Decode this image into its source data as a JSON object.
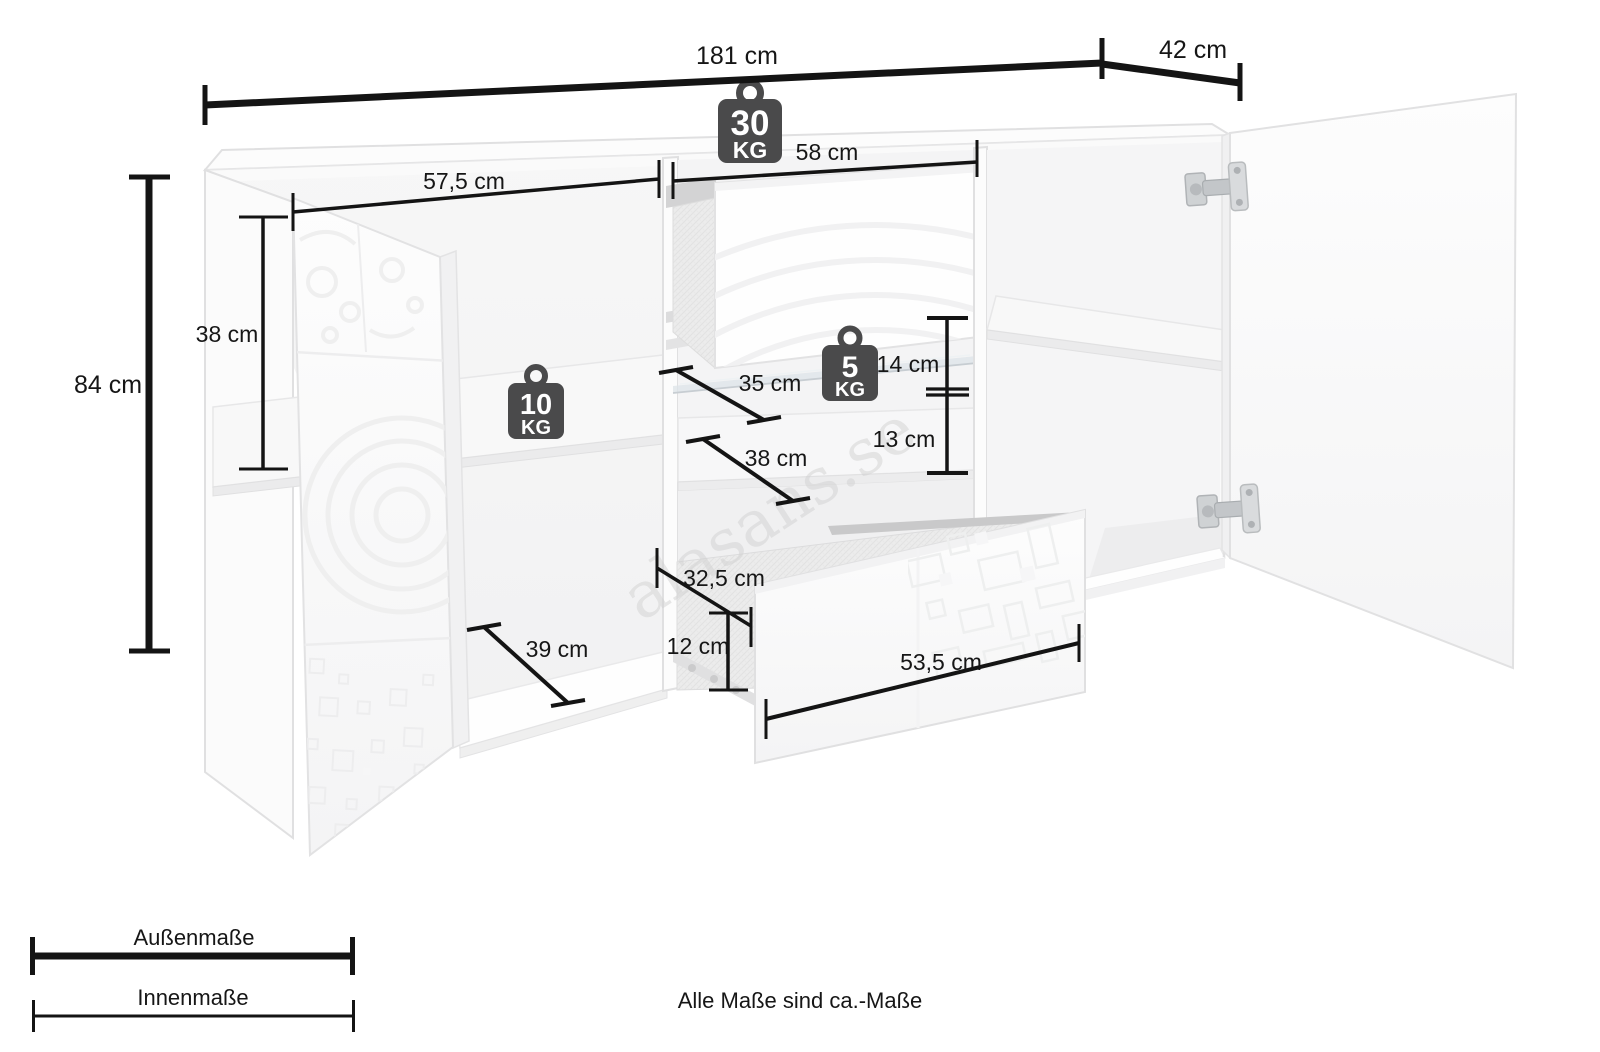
{
  "diagram": {
    "dimensions": {
      "outer": [
        {
          "id": "total-width",
          "label": "181 cm"
        },
        {
          "id": "total-depth",
          "label": "42 cm"
        },
        {
          "id": "total-height",
          "label": "84 cm"
        }
      ],
      "inner": [
        {
          "id": "left-inner-height",
          "label": "38 cm"
        },
        {
          "id": "left-section-width",
          "label": "57,5 cm"
        },
        {
          "id": "mid-section-width",
          "label": "58 cm"
        },
        {
          "id": "glass-shelf-depth",
          "label": "35 cm"
        },
        {
          "id": "glass-clearance",
          "label": "14 cm"
        },
        {
          "id": "shelf-clearance",
          "label": "13 cm"
        },
        {
          "id": "wood-shelf-depth",
          "label": "38 cm"
        },
        {
          "id": "left-section-depth",
          "label": "39 cm"
        },
        {
          "id": "drawer-inner-depth",
          "label": "32,5 cm"
        },
        {
          "id": "drawer-inner-height",
          "label": "12 cm"
        },
        {
          "id": "drawer-inner-width",
          "label": "53,5 cm"
        }
      ]
    },
    "load_capacity": {
      "top_board": {
        "value": "30",
        "unit": "KG"
      },
      "wood_shelf": {
        "value": "10",
        "unit": "KG"
      },
      "glass_shelf": {
        "value": "5",
        "unit": "KG"
      }
    },
    "legend": {
      "outer_label": "Außenmaße",
      "inner_label": "Innenmaße"
    },
    "footnote": "Alle Maße sind ca.-Maße",
    "watermark": "alasans.se",
    "colors": {
      "dimension_line": "#141414",
      "weight_badge": "#4a4a4b",
      "furniture_line": "#e0e0e1"
    }
  }
}
